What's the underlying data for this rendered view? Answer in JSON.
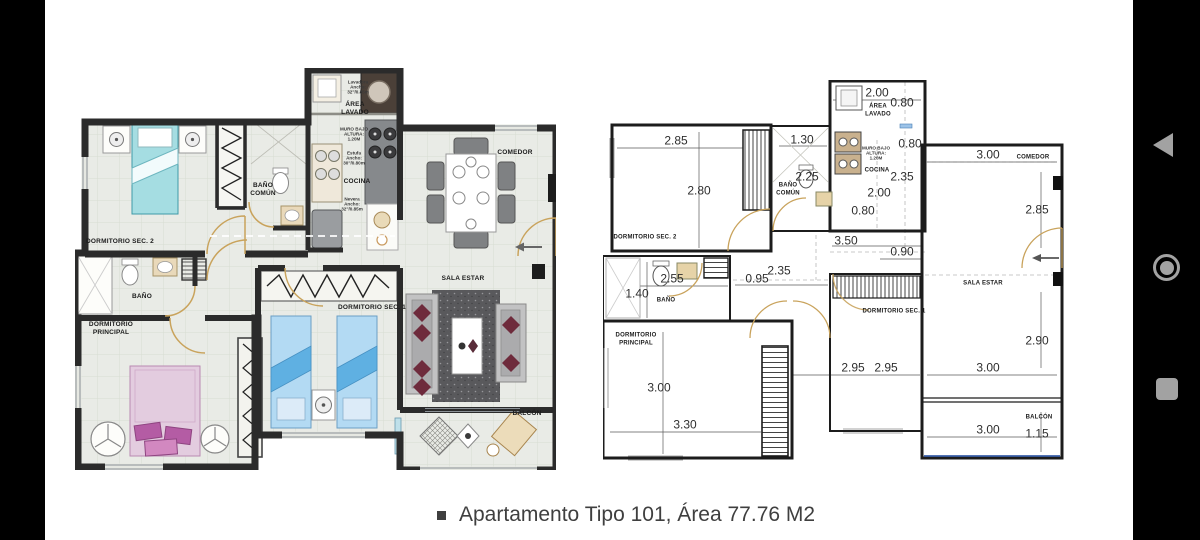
{
  "caption": {
    "text": "Apartamento Tipo 101, Área 77.76 M2"
  },
  "nav_bar": {
    "back_icon": "back",
    "home_icon": "home",
    "recents_icon": "recents"
  },
  "left_plan": {
    "labels": {
      "lavadora_note": "Lavadora\nAncho:\n32\"/0.85m",
      "area_lavado": "ÁREA\nLAVADO",
      "muro_bajo": "MURO BAJO\nALTURA:\n1.20M",
      "estufa_note": "Estufa\nAncho:\n30\"/0.80m",
      "cocina": "COCINA",
      "nevera_note": "Nevera\nAncho:\n32\"/0.85m",
      "comedor": "COMEDOR",
      "dormitorio_sec_2": "DORMITORIO SEC. 2",
      "banio_comun": "BAÑO\nCOMÚN",
      "banio": "BAÑO",
      "dormitorio_principal": "DORMITORIO\nPRINCIPAL",
      "dormitorio_sec_1": "DORMITORIO SEC. 1",
      "sala_estar": "SALA ESTAR",
      "balcon": "BALCÓN"
    }
  },
  "right_plan": {
    "labels": {
      "area_lavado": "ÁREA\nLAVADO",
      "muro_bajo": "MURO BAJO\nALTURA:\n1.20M",
      "cocina": "COCINA",
      "comedor": "COMEDOR",
      "banio_comun": "BAÑO\nCOMÚN",
      "dormitorio_sec_2": "DORMITORIO SEC. 2",
      "banio": "BAÑO",
      "sala_estar": "SALA ESTAR",
      "dormitorio_sec_1": "DORMITORIO SEC. 1",
      "dormitorio_principal": "DORMITORIO\nPRINCIPAL",
      "balcon": "BALCÓN"
    },
    "dims": {
      "lavado_w": "2.00",
      "lavado_d": "0.80",
      "hall_top": "1.30",
      "dorm2_w": "2.85",
      "muro_d": "0.80",
      "comedor_w": "3.00",
      "dorm2_h": "2.80",
      "banio_comun_w": "2.25",
      "cocina_h": "2.35",
      "cocina_w": "2.00",
      "cocina_d": "0.80",
      "comedor_h": "2.85",
      "cocina_total": "3.50",
      "pasillo_w": "0.90",
      "pasillo_l": "2.35",
      "pasillo_h": "0.95",
      "banio_w": "2.55",
      "banio_h": "1.40",
      "sala_h": "2.90",
      "dorm1_w1": "2.95",
      "dorm1_w2": "2.95",
      "sala_w": "3.00",
      "dormp_h": "3.00",
      "dormp_w": "3.30",
      "balcon_w": "3.00",
      "balcon_h": "1.15"
    }
  }
}
